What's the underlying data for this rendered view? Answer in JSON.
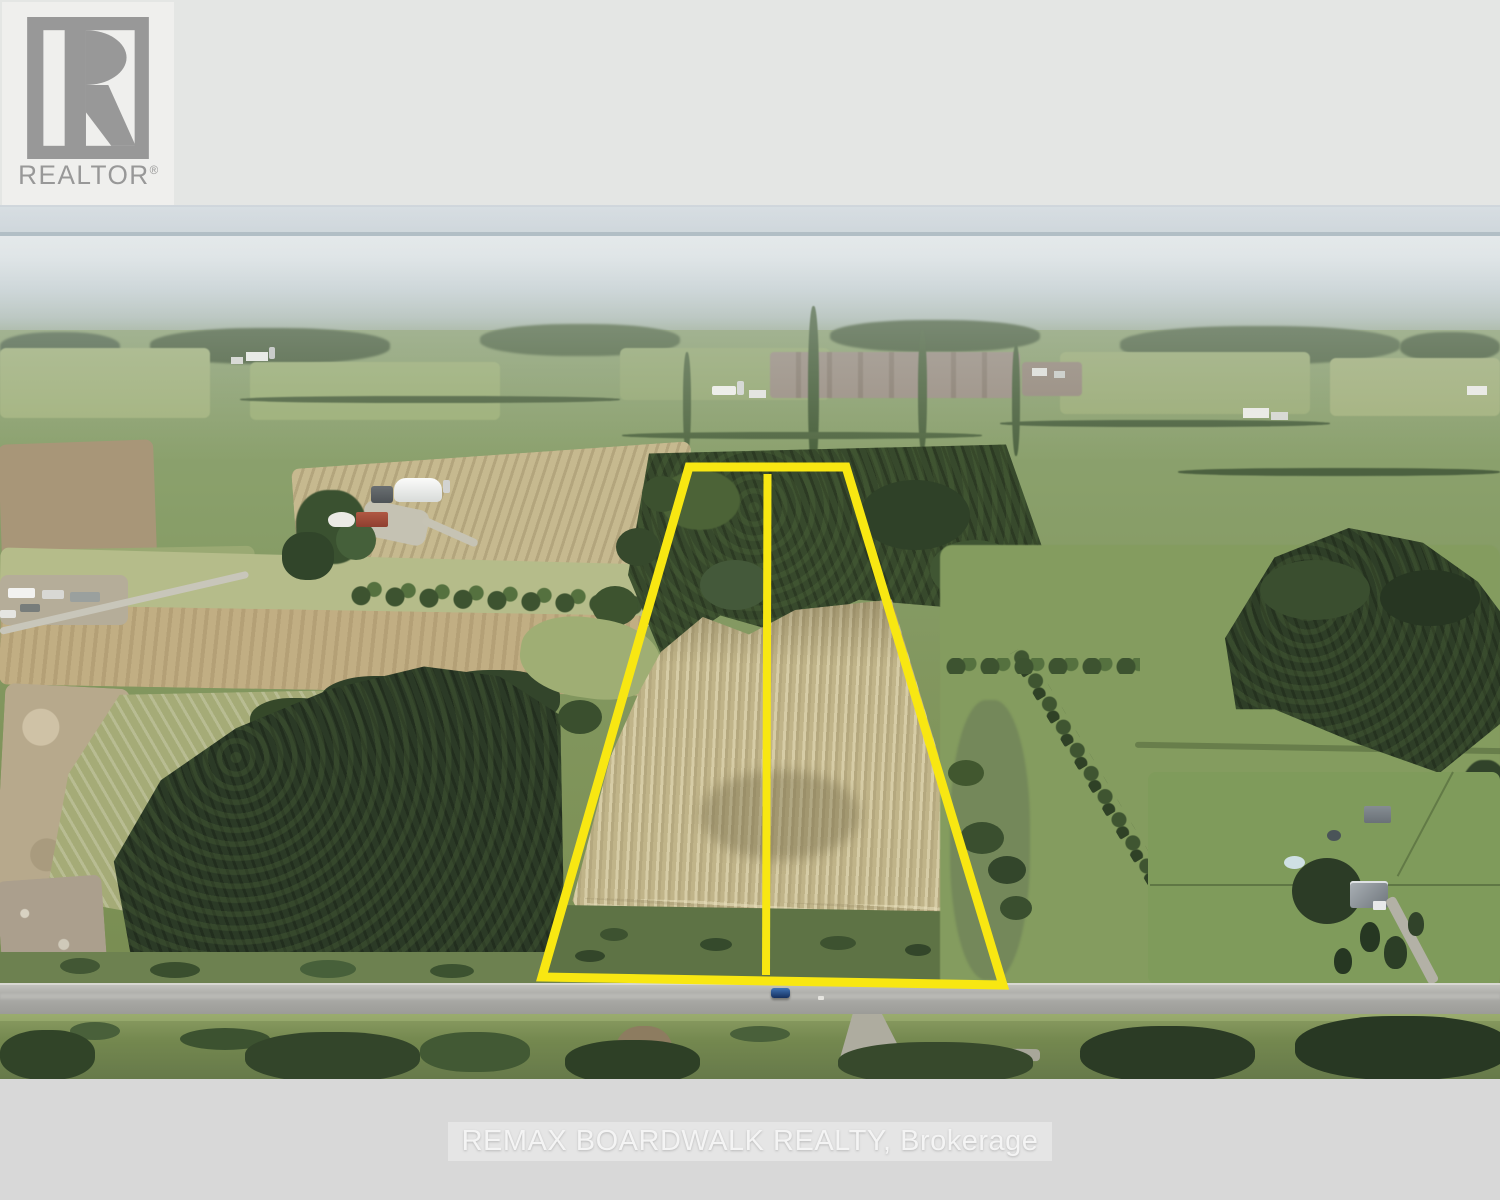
{
  "branding": {
    "logo_text": "REALTOR",
    "registered_mark": "®"
  },
  "watermark": {
    "text": "REMAX BOARDWALK REALTY, Brokerage"
  },
  "parcel": {
    "lot_count": 2,
    "shape": "trapezoid with center divider",
    "boundary_color": "#f8e712"
  },
  "vehicles": {
    "road_car_color": "#2f72ad"
  },
  "colors": {
    "boundary_yellow": "#f8e712",
    "top_band": "#e4e6e4",
    "bottom_band": "#d8d8d8",
    "horizon_line": "#8b9da8",
    "field_beige": "#c0b489",
    "forest_dark": "#2e3e27",
    "road_gray": "#a8a8a4",
    "car_blue": "#2f72ad",
    "logo_gray": "#989898",
    "watermark_text": "#f4f4f4"
  }
}
